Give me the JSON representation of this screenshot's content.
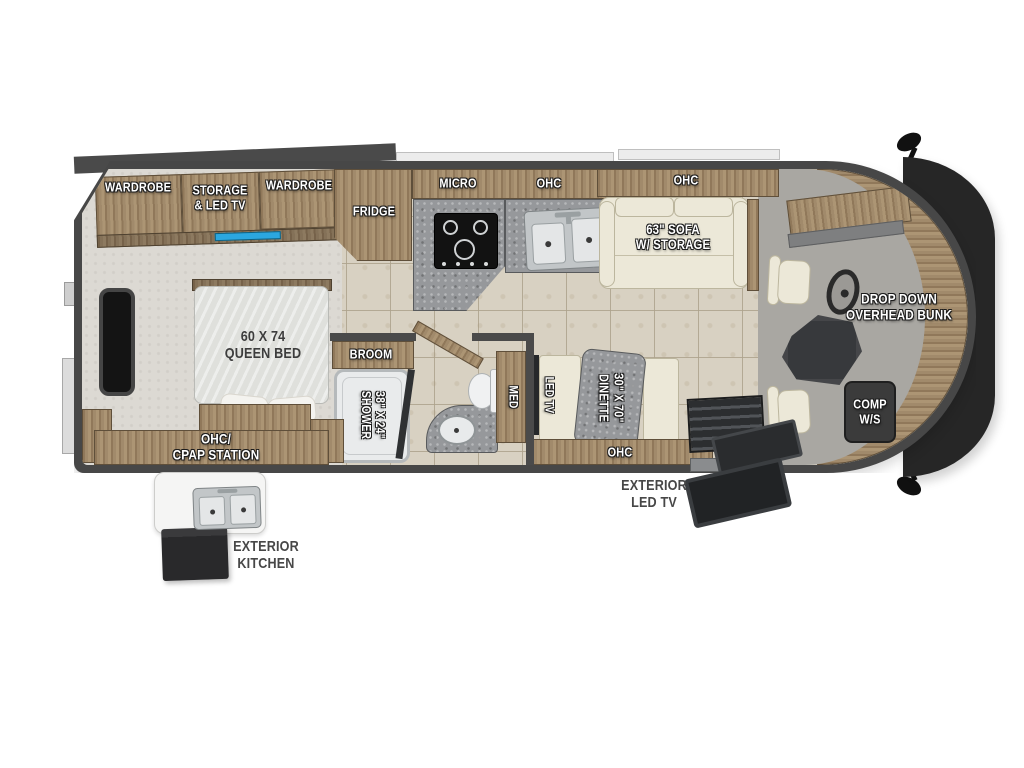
{
  "diagram": {
    "type": "rv-floor-plan",
    "colors": {
      "wall": "#474747",
      "bumper": "#262626",
      "wood": "#a18a6b",
      "wood_dark": "#7d6950",
      "floor_tile": "#d8d1c2",
      "carpet": "#dcd9d3",
      "cab_floor": "#a9a7a2",
      "counter": "#96989b",
      "upholstery": "#ece8d8",
      "accent_blue": "#2ba7e0",
      "steel": "#c2c6c8",
      "label_light": "#ffffff",
      "label_dark": "#474747"
    },
    "icons": {
      "cooktop-icon": "4-burner cooktop",
      "kitchen-sink-icon": "double-basin sink with faucet",
      "bath-sink-icon": "oval lavatory sink",
      "toilet-icon": "toilet with tank",
      "shower-glass-icon": "shower glass panel",
      "steering-wheel-icon": "steering wheel",
      "side-mirror-icon": "side mirror",
      "entry-steps-icon": "entry door steps",
      "exterior-tv-icon": "exterior LED TV panel",
      "exterior-sink-icon": "exterior double sink",
      "led-tv-icon": "LED TV with blue screen edge",
      "window-icon": "bedroom window"
    }
  },
  "labels": {
    "wardrobe_left": "WARDROBE",
    "storage_led_tv": "STORAGE\n& LED TV",
    "wardrobe_right": "WARDROBE",
    "fridge": "FRIDGE",
    "micro": "MICRO",
    "ohc_kitchen": "OHC",
    "ohc_sofa": "OHC",
    "sofa": "63\" SOFA\nW/ STORAGE",
    "drop_down_bunk": "DROP DOWN\nOVERHEAD BUNK",
    "comp_ws": "COMP\nW/S",
    "queen_bed": "60 X 74\nQUEEN BED",
    "ohc_cpap": "OHC/\nCPAP STATION",
    "exterior_kitchen": "EXTERIOR\nKITCHEN",
    "broom": "BROOM",
    "shower": "38\" X 24\"\nSHOWER",
    "med": "MED",
    "led_tv": "LED TV",
    "dinette": "30\" X 70\"\nDINETTE",
    "ohc_dinette": "OHC",
    "exterior_led_tv": "EXTERIOR\nLED TV"
  }
}
